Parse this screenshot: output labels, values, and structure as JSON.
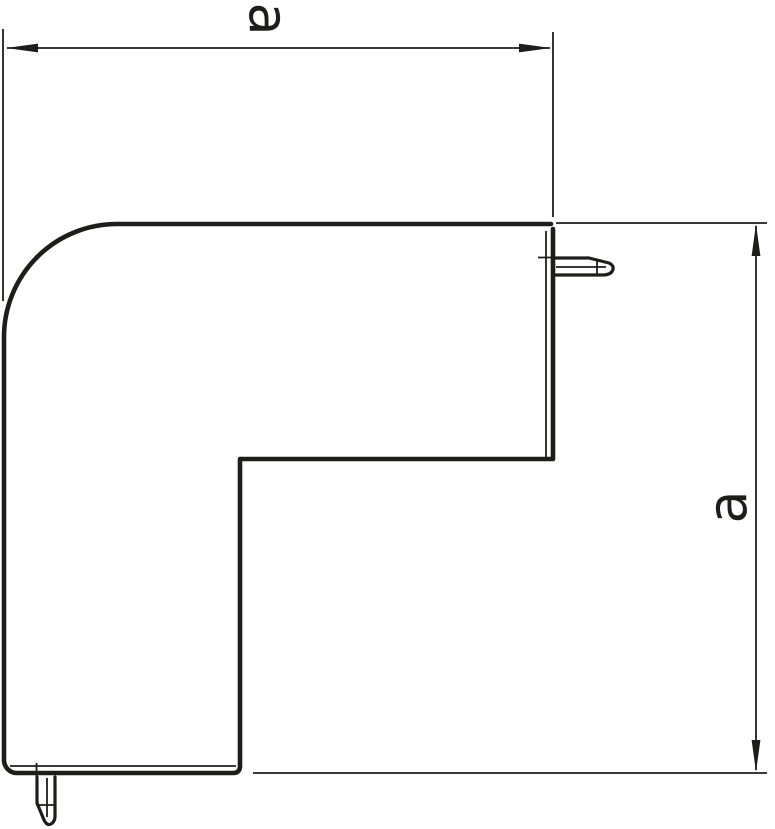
{
  "drawing": {
    "kind": "technical-line-drawing",
    "subject": "flat-angle-trunking-corner-piece",
    "background_color": "#ffffff",
    "line_color": "#1d1d1b",
    "dimensions": {
      "horizontal": {
        "label": "a",
        "orientation": "rotated-90-cw"
      },
      "vertical": {
        "label": "a",
        "orientation": "rotated-90-ccw"
      }
    }
  }
}
